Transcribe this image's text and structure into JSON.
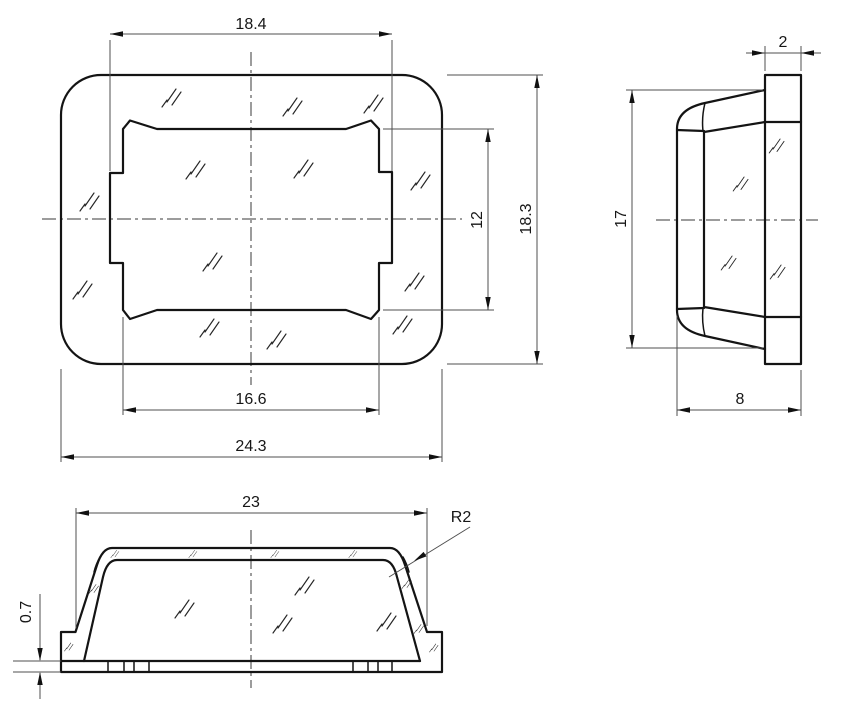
{
  "drawing": {
    "background": "#ffffff",
    "outline_color": "#141414",
    "dimension_color": "#4f4f4f"
  },
  "views": {
    "front": {
      "dims": {
        "tab_width": "18.4",
        "opening_width": "16.6",
        "overall_width": "24.3",
        "overall_height": "18.3",
        "opening_height": "12"
      }
    },
    "side": {
      "dims": {
        "flange_thickness": "2",
        "body_height": "17",
        "depth": "8"
      }
    },
    "bottom": {
      "dims": {
        "top_width": "23",
        "corner_radius": "R2",
        "base_thickness": "0.7"
      }
    }
  }
}
